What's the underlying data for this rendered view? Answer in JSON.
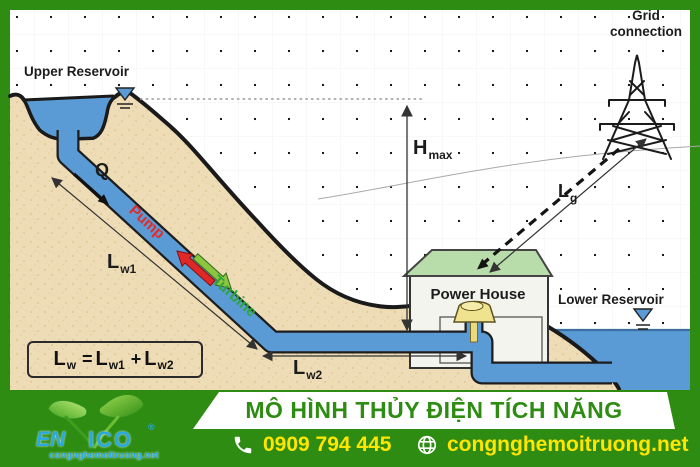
{
  "diagram": {
    "labels": {
      "upper_reservoir": "Upper Reservoir",
      "lower_reservoir": "Lower  Reservoir",
      "grid_line1": "Grid",
      "grid_line2": "connection",
      "power_house": "Power House",
      "flow": "Q",
      "pump": "Pump",
      "turbine": "Turbine"
    },
    "dimensions": {
      "h_base": "H",
      "h_sub": "max",
      "lw1_base": "L",
      "lw1_sub": "w1",
      "lw2_base": "L",
      "lw2_sub": "w2",
      "lg_base": "L",
      "lg_sub": "g"
    },
    "formula": {
      "lhs_base": "L",
      "lhs_sub": "w",
      "equals": "=",
      "term1_base": "L",
      "term1_sub": "w1",
      "plus": "+",
      "term2_base": "L",
      "term2_sub": "w2"
    },
    "colors": {
      "water_blue": "#5b9bd5",
      "sand": "#eddcb6",
      "roof_green": "#b9dcab",
      "pump_red": "#e02828",
      "turbine_green": "#8cc63f"
    }
  },
  "banner": {
    "title": "MÔ HÌNH THỦY ĐIỆN TÍCH NĂNG",
    "phone": "0909 794 445",
    "website": "congnghemoitruong.net",
    "logo": {
      "brand_left": "EN",
      "brand_right": "ICO",
      "registered": "®",
      "tagline": "congnghemoitruong.net"
    },
    "colors": {
      "banner_green": "#2e8c12",
      "accent_yellow": "#ffe600",
      "logo_blue": "#2aa9e0"
    }
  }
}
